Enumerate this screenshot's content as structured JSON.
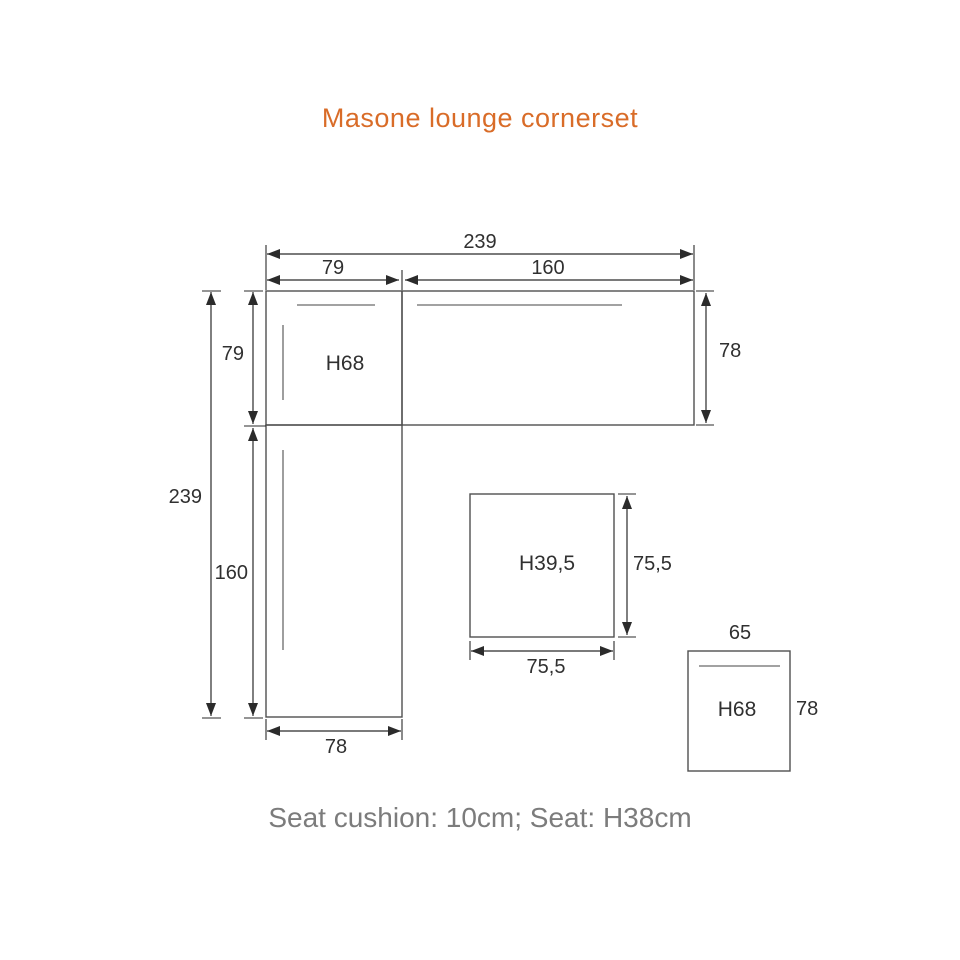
{
  "page": {
    "title": "Masone lounge cornerset",
    "caption": "Seat cushion: 10cm; Seat: H38cm"
  },
  "colors": {
    "title_accent": "#d96c28",
    "caption_gray": "#7c7c7c",
    "outline_gray": "#4f4f4f",
    "dimension_ink": "#2b2b2b",
    "seat_line_gray": "#949494",
    "background": "#ffffff"
  },
  "diagram": {
    "type": "furniture-dimension-drawing",
    "unit": "cm",
    "dims": {
      "top_total": "239",
      "top_left_segment": "79",
      "top_right_segment": "160",
      "left_total": "239",
      "left_upper_segment": "79",
      "left_lower_segment": "160",
      "right_side_depth": "78",
      "bottom_width": "78",
      "corner_height_label": "H68",
      "table_height_label": "H39,5",
      "table_depth": "75,5",
      "table_width": "75,5",
      "stool_width": "65",
      "stool_depth": "78",
      "stool_height_label": "H68"
    }
  }
}
